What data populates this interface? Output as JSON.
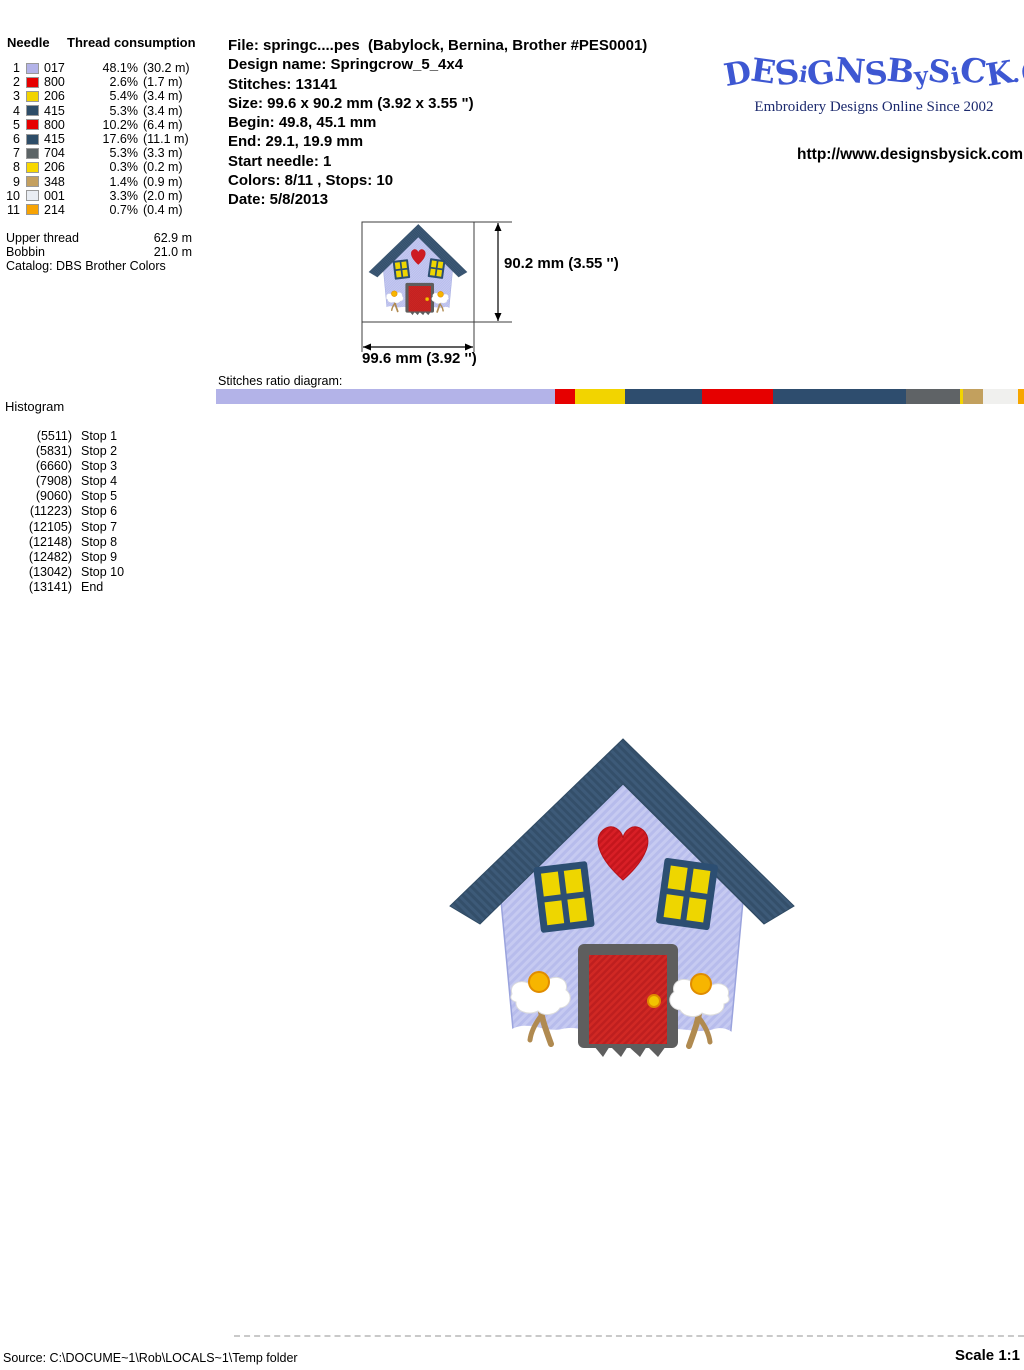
{
  "thread_table": {
    "col1_header": "Needle",
    "col2_header": "Thread consumption",
    "rows": [
      {
        "needle": "1",
        "code": "017",
        "color": "#b3b3e8",
        "pct": "48.1%",
        "len": "(30.2 m)"
      },
      {
        "needle": "2",
        "code": "800",
        "color": "#e60000",
        "pct": "2.6%",
        "len": "(1.7 m)"
      },
      {
        "needle": "3",
        "code": "206",
        "color": "#f2d400",
        "pct": "5.4%",
        "len": "(3.4 m)"
      },
      {
        "needle": "4",
        "code": "415",
        "color": "#2e4d68",
        "pct": "5.3%",
        "len": "(3.4 m)"
      },
      {
        "needle": "5",
        "code": "800",
        "color": "#e60000",
        "pct": "10.2%",
        "len": "(6.4 m)"
      },
      {
        "needle": "6",
        "code": "415",
        "color": "#2e4d68",
        "pct": "17.6%",
        "len": "(11.1 m)"
      },
      {
        "needle": "7",
        "code": "704",
        "color": "#5c6466",
        "pct": "5.3%",
        "len": "(3.3 m)"
      },
      {
        "needle": "8",
        "code": "206",
        "color": "#f8d800",
        "pct": "0.3%",
        "len": "(0.2 m)"
      },
      {
        "needle": "9",
        "code": "348",
        "color": "#c4a05f",
        "pct": "1.4%",
        "len": "(0.9 m)"
      },
      {
        "needle": "10",
        "code": "001",
        "color": "#e9edf3",
        "pct": "3.3%",
        "len": "(2.0 m)"
      },
      {
        "needle": "11",
        "code": "214",
        "color": "#f7a303",
        "pct": "0.7%",
        "len": "(0.4 m)"
      }
    ]
  },
  "totals": {
    "upper_label": "Upper thread",
    "upper_value": "62.9 m",
    "bobbin_label": "Bobbin",
    "bobbin_value": "21.0 m",
    "catalog": "Catalog: DBS Brother Colors"
  },
  "file_info": {
    "lines": [
      "File: springc....pes  (Babylock, Bernina, Brother #PES0001)",
      "Design name: Springcrow_5_4x4",
      "Stitches: 13141",
      "Size: 99.6 x 90.2 mm (3.92 x 3.55 \")",
      "Begin: 49.8, 45.1 mm",
      "End: 29.1, 19.9 mm",
      "Start needle: 1",
      "Colors: 8/11 , Stops: 10",
      "Date: 5/8/2013"
    ]
  },
  "branding": {
    "logo_text": "DESiGNSBySiCK.CoM",
    "logo_color": "#3d57d2",
    "tagline": "Embroidery Designs Online Since 2002",
    "url": "http://www.designsbysick.com"
  },
  "dimensions": {
    "height_label": "90.2 mm (3.55 '')",
    "width_label": "99.6 mm (3.92 '')"
  },
  "ratio_diagram": {
    "label": "Stitches ratio diagram:",
    "segments": [
      {
        "color": "#b3b3e8",
        "pct": 41.94
      },
      {
        "color": "#e60000",
        "pct": 2.43
      },
      {
        "color": "#f2d400",
        "pct": 6.31
      },
      {
        "color": "#2e4d6e",
        "pct": 9.5
      },
      {
        "color": "#e60000",
        "pct": 8.77
      },
      {
        "color": "#2e4d6e",
        "pct": 16.46
      },
      {
        "color": "#5f6366",
        "pct": 6.71
      },
      {
        "color": "#f2d400",
        "pct": 0.33
      },
      {
        "color": "#c2a05e",
        "pct": 2.54
      },
      {
        "color": "#f0f0ee",
        "pct": 4.26
      },
      {
        "color": "#f7a600",
        "pct": 0.75
      }
    ]
  },
  "histogram": {
    "label": "Histogram",
    "entries": [
      {
        "count": "(5511)",
        "label": "Stop 1"
      },
      {
        "count": "(5831)",
        "label": "Stop 2"
      },
      {
        "count": "(6660)",
        "label": "Stop 3"
      },
      {
        "count": "(7908)",
        "label": "Stop 4"
      },
      {
        "count": "(9060)",
        "label": "Stop 5"
      },
      {
        "count": "(11223)",
        "label": "Stop 6"
      },
      {
        "count": "(12105)",
        "label": "Stop 7"
      },
      {
        "count": "(12148)",
        "label": "Stop 8"
      },
      {
        "count": "(12482)",
        "label": "Stop 9"
      },
      {
        "count": "(13042)",
        "label": "Stop 10"
      },
      {
        "count": "(13141)",
        "label": "End"
      }
    ]
  },
  "artwork_colors": {
    "roof": "#3d5a78",
    "walls": "#c6caf1",
    "heart": "#d81f26",
    "door": "#d02824",
    "door_frame": "#5e5e5e",
    "window_frame": "#2c4e72",
    "window_pane": "#eed600",
    "flower_center": "#f7b500",
    "stem": "#b08a50"
  },
  "footer": {
    "source": "Source: C:\\DOCUME~1\\Rob\\LOCALS~1\\Temp folder",
    "scale": "Scale 1:1"
  }
}
